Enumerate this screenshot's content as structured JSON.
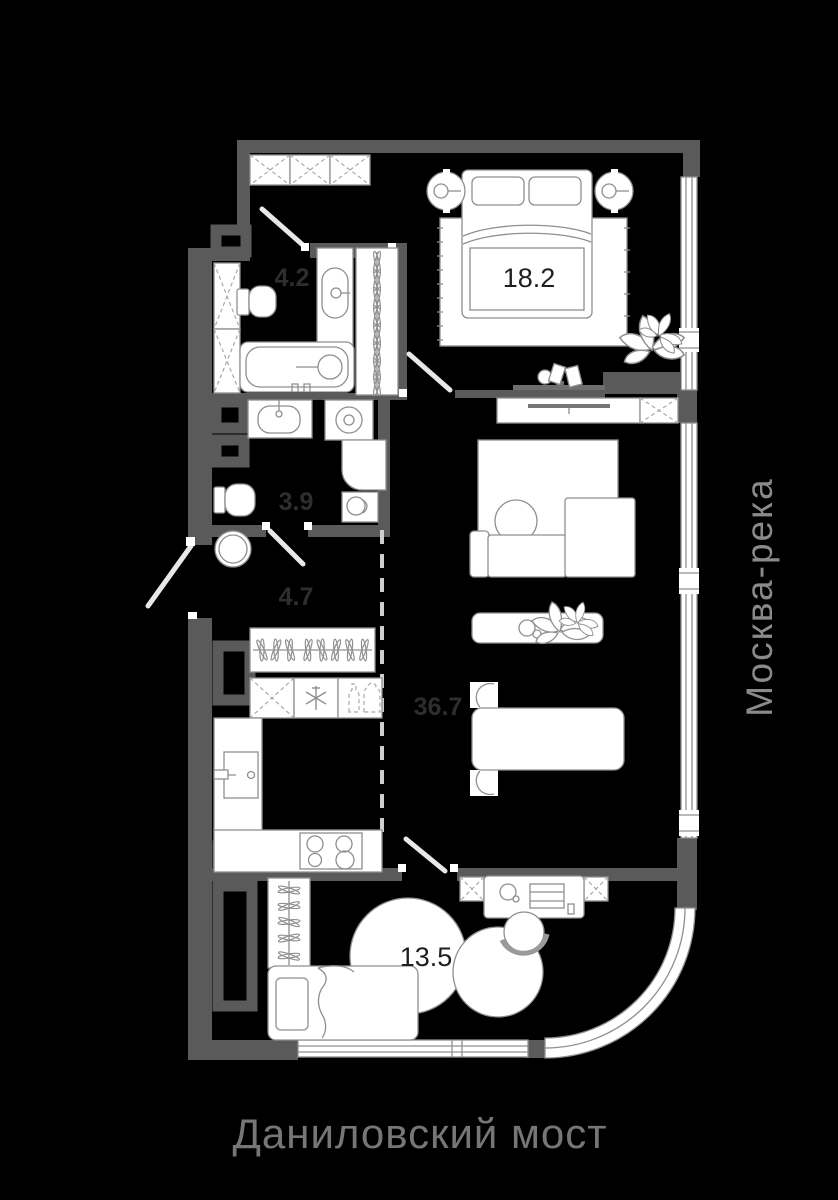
{
  "plan_title": "apartment-floor-plan",
  "rooms": {
    "bathroom_main": {
      "area": "4.2"
    },
    "bedroom": {
      "area": "18.2"
    },
    "bathroom_guest": {
      "area": "3.9"
    },
    "hallway": {
      "area": "4.7"
    },
    "living_kitchen": {
      "area": "36.7"
    },
    "bedroom_small": {
      "area": "13.5"
    }
  },
  "captions": {
    "right": "Москва-река",
    "bottom": "Даниловский мост"
  },
  "colors": {
    "background": "#000000",
    "walls": "#5a5a5a",
    "room_fill": "#000000",
    "furniture_fill": "#ffffff",
    "furniture_outline": "#8f8f8f",
    "label_on_dark": "#2e2e2e",
    "label_on_light": "#1f1f1f",
    "caption_right": "#8a8a8a",
    "caption_bottom": "#767676"
  }
}
